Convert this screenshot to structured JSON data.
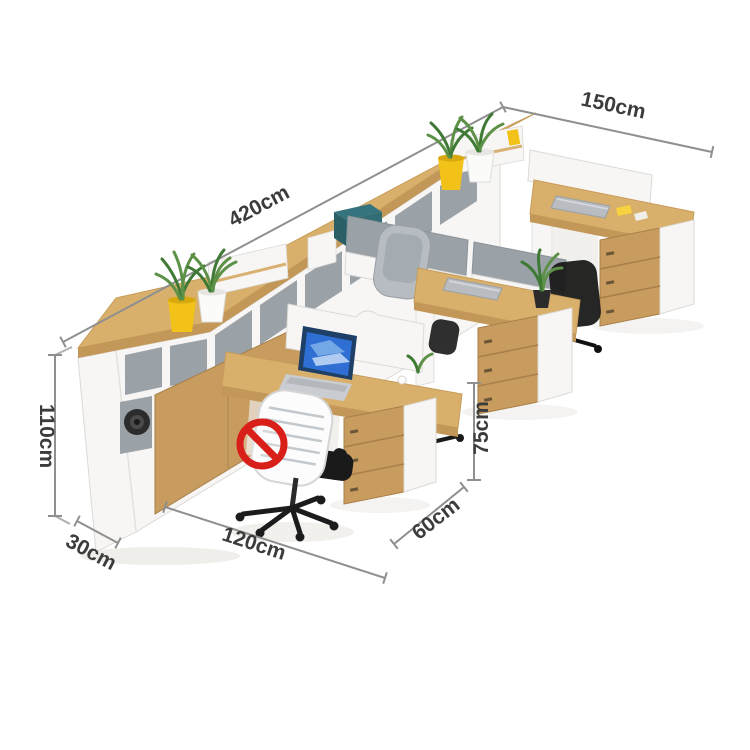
{
  "image": {
    "type": "product-dimension-diagram",
    "subject": "staggered 3-seat office workstation with high counter cabinet, desks, pedestals and chair",
    "background": "#ffffff"
  },
  "dimensions": {
    "total_length": {
      "label": "420cm"
    },
    "return_length": {
      "label": "150cm"
    },
    "counter_height": {
      "label": "110cm"
    },
    "counter_depth": {
      "label": "30cm"
    },
    "desk_length": {
      "label": "120cm"
    },
    "desk_depth": {
      "label": "60cm"
    },
    "desk_height": {
      "label": "75cm"
    }
  },
  "scene": {
    "objects": [
      "wood-counter-cabinet",
      "open-cubby-shelves",
      "wood-cabinet-door",
      "speaker",
      "bag",
      "desk-1",
      "desk-2",
      "desk-3",
      "privacy-screens",
      "open-laptop",
      "closed-laptops",
      "drawer-pedestals",
      "office-chair",
      "gray-task-chairs",
      "prohibition-sign",
      "potted-plants",
      "yellow-pots",
      "white-pots",
      "teal-storage-box",
      "sticky-notes"
    ]
  },
  "colors": {
    "wood": "#d8b06c",
    "wood-stroke": "#c79c5a",
    "wood-dark": "#c29758",
    "wood-front": "#c89b5e",
    "wood-front-stroke": "#a87f49",
    "panel": "#f7f6f4",
    "panel-line": "#dcdad6",
    "cubby": "#9aa1a7",
    "screen-gray": "#9aa2a8",
    "teal": "#35747e",
    "teal-dark": "#2a5f68",
    "teal-side": "#326d76",
    "pot-yellow": "#f2c218",
    "green": "#5d9147",
    "green-dark": "#3f7a35",
    "laptop-blue": "#2f6fd4",
    "gray-laptop": "#b9bdc2",
    "black": "#1a1a1a",
    "red": "#d81f1a",
    "dim": "#8f8f8f",
    "dim-text": "#3c3c3c",
    "shadow": "#eceae6"
  }
}
